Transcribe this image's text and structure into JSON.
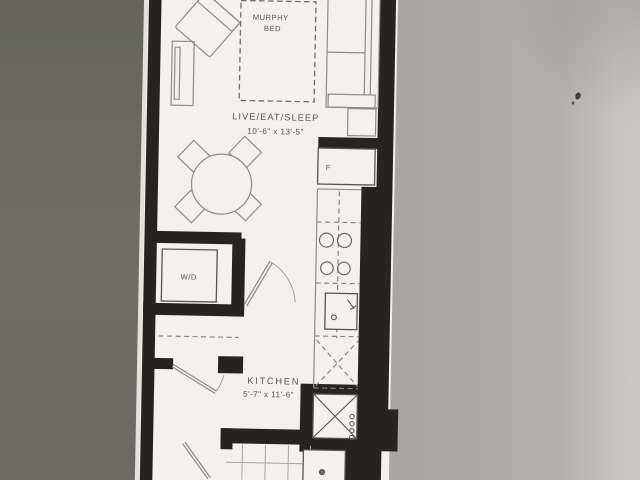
{
  "floorplan": {
    "living": {
      "murphy_line1": "MURPHY",
      "murphy_line2": "BED",
      "name": "LIVE/EAT/SLEEP",
      "dims": "10'-6\" x 13'-5\""
    },
    "kitchen": {
      "name": "KITCHEN",
      "dims": "5'-7\" x 11'-6\""
    },
    "appliances": {
      "fridge": "F",
      "washer_dryer": "W/D"
    },
    "colors": {
      "paper": "#f3f1ed",
      "wall_ink": "#272320",
      "furniture_line": "#8f8b85",
      "label_ink": "#56524c",
      "surface_left": "#6b6b63",
      "surface_right": "#a8a6a3",
      "surface_highlight": "#cbc9c5"
    }
  }
}
